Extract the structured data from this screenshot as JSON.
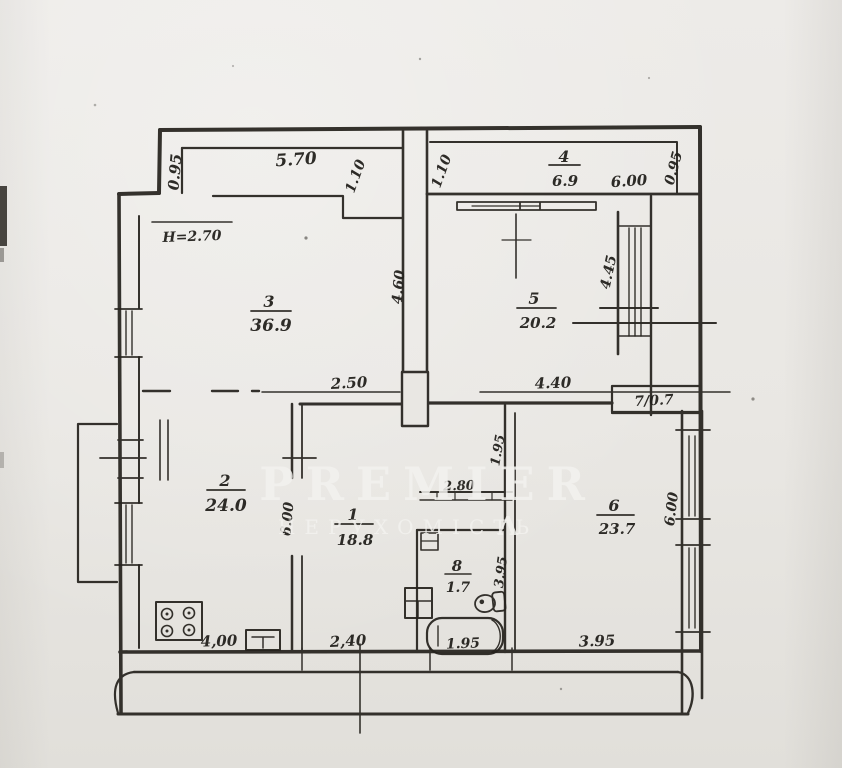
{
  "watermark": {
    "brand": "PREMIER",
    "subtitle": "НЕРУХОМІСТЬ",
    "logo_glyph": "Λ"
  },
  "note_height": "H=2.70",
  "rooms": [
    {
      "number": "1",
      "area": "18.8"
    },
    {
      "number": "2",
      "area": "24.0"
    },
    {
      "number": "3",
      "area": "36.9"
    },
    {
      "number": "4",
      "area": "6.9"
    },
    {
      "number": "5",
      "area": "20.2"
    },
    {
      "number": "6",
      "area": "23.7"
    },
    {
      "number": "7",
      "area": "0.7",
      "label": "7/0.7"
    },
    {
      "number": "8",
      "area": "1.7"
    }
  ],
  "dimensions": {
    "entry_depth": "0.95",
    "entry_width": "5.70",
    "passage_left": "1.10",
    "passage_right": "1.10",
    "room4_width": "6.00",
    "room4_depth": "0.95",
    "room3_wall": "4.60",
    "room5_wall": "4.45",
    "hall_left": "2.50",
    "hall_right": "4.40",
    "corridor": "1.95",
    "closet_width": "2.80",
    "room2_wall": "6.00",
    "bath_depth": "3.95",
    "room6_wall": "6.00",
    "room2_bottom": "4,00",
    "room1_bottom": "2,40",
    "bathtub_length": "1.95",
    "room6_bottom": "3.95"
  }
}
